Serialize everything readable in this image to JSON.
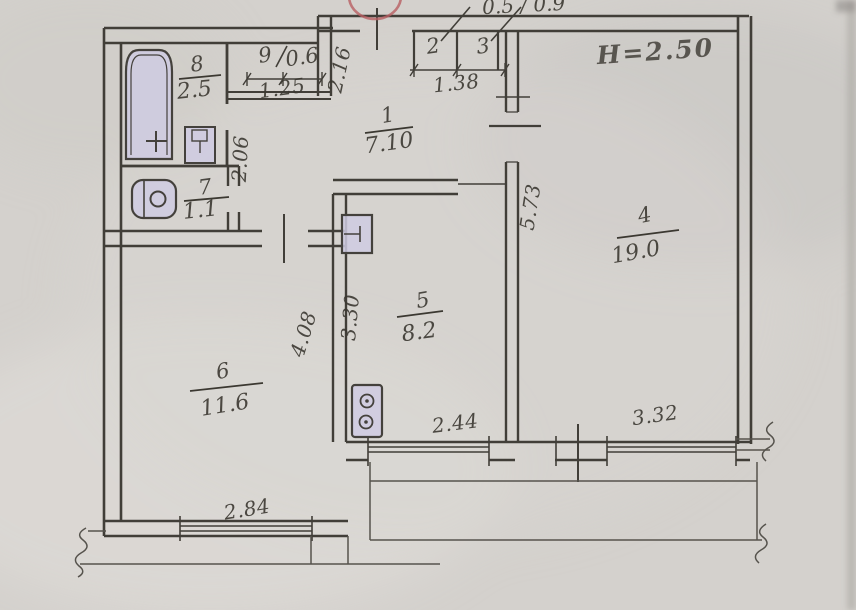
{
  "annotations": {
    "ceiling_height": "H=2.50",
    "upper_cut": "0.5 / 0.9"
  },
  "colors": {
    "paper": "#d4d1cd",
    "ink": "#413e38",
    "handwriting": "#3b3831",
    "fixture_fill": "#cfcbe2",
    "height_note": "#8e89a7",
    "stamp": "#b85f63"
  },
  "rooms": {
    "hall": {
      "number": "1",
      "area": "7.10"
    },
    "closet_left": {
      "number": "2"
    },
    "closet_right": {
      "number": "3"
    },
    "living": {
      "number": "4",
      "area": "19.0"
    },
    "kitchen": {
      "number": "5",
      "area": "8.2"
    },
    "room6": {
      "number": "6",
      "area": "11.6"
    },
    "wc": {
      "number": "7",
      "area": "1.1"
    },
    "bathroom": {
      "number": "8",
      "area": "2.5"
    },
    "niche": {
      "number": "9",
      "area": "0.6"
    }
  },
  "dimensions": {
    "niche_width": "1.25",
    "entry_wall": "2.16",
    "closets_width": "1.38",
    "bath_block": "2.06",
    "living_depth": "5.73",
    "kitchen_depth": "3.30",
    "room6_depth": "4.08",
    "kitchen_window": "2.44",
    "living_window": "3.32",
    "room6_window": "2.84"
  },
  "fixtures": {
    "bathtub": "bathtub-icon",
    "bath_sink": "sink-icon",
    "toilet": "toilet-icon",
    "kitchen_sink": "kitchen-sink-icon",
    "stove": "stove-icon"
  }
}
